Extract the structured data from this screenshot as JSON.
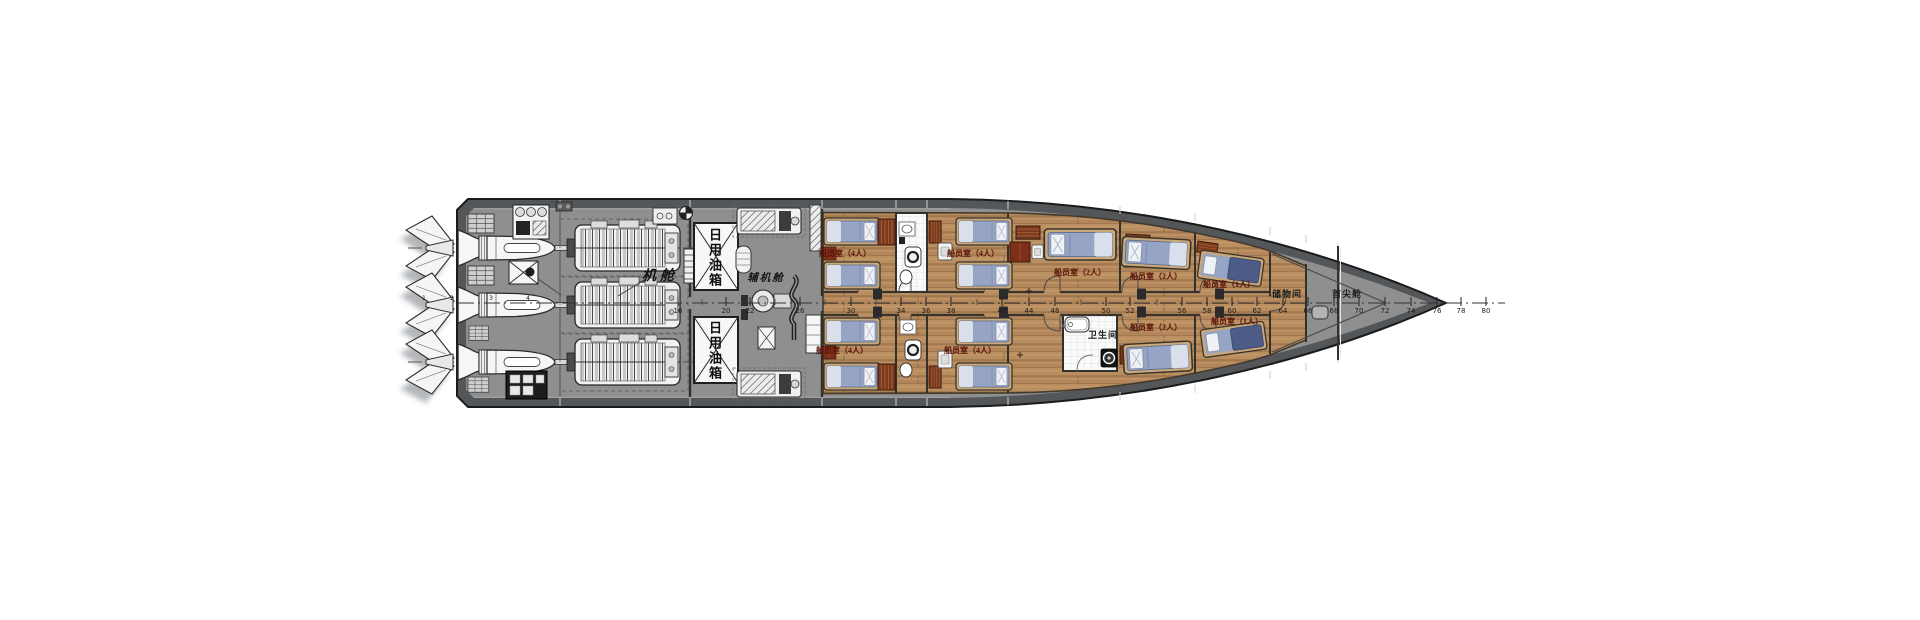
{
  "rooms": {
    "engine_room": "机舱",
    "aux_engine_room": "辅机舱",
    "day_fuel_tank": "日用油箱",
    "crew_cabin_4": "船员室（4人）",
    "crew_cabin_2": "船员室（2人）",
    "crew_cabin_1": "船员室（1人）",
    "bathroom": "卫生间",
    "storage_room": "储物间",
    "fore_peak": "首尖舱"
  },
  "frame_numbers": [
    "16",
    "20",
    "22",
    "26",
    "30",
    "34",
    "36",
    "38",
    "42",
    "44",
    "46",
    "50",
    "52",
    "56",
    "58",
    "60",
    "62",
    "64",
    "66",
    "68",
    "70",
    "72",
    "74",
    "76",
    "78",
    "80"
  ],
  "waterjet_callouts": [
    "1",
    "2",
    "3",
    "4"
  ],
  "colors": {
    "hull_band": "#54575a",
    "deck_grey": "#8f8f8f",
    "wood_floor": "#b98e60",
    "mattress_blue": "#96a5c5",
    "blanket_navy": "#4d5c86",
    "furniture_maroon": "#7e2f1b",
    "cabin_label_red": "#5a1408"
  }
}
